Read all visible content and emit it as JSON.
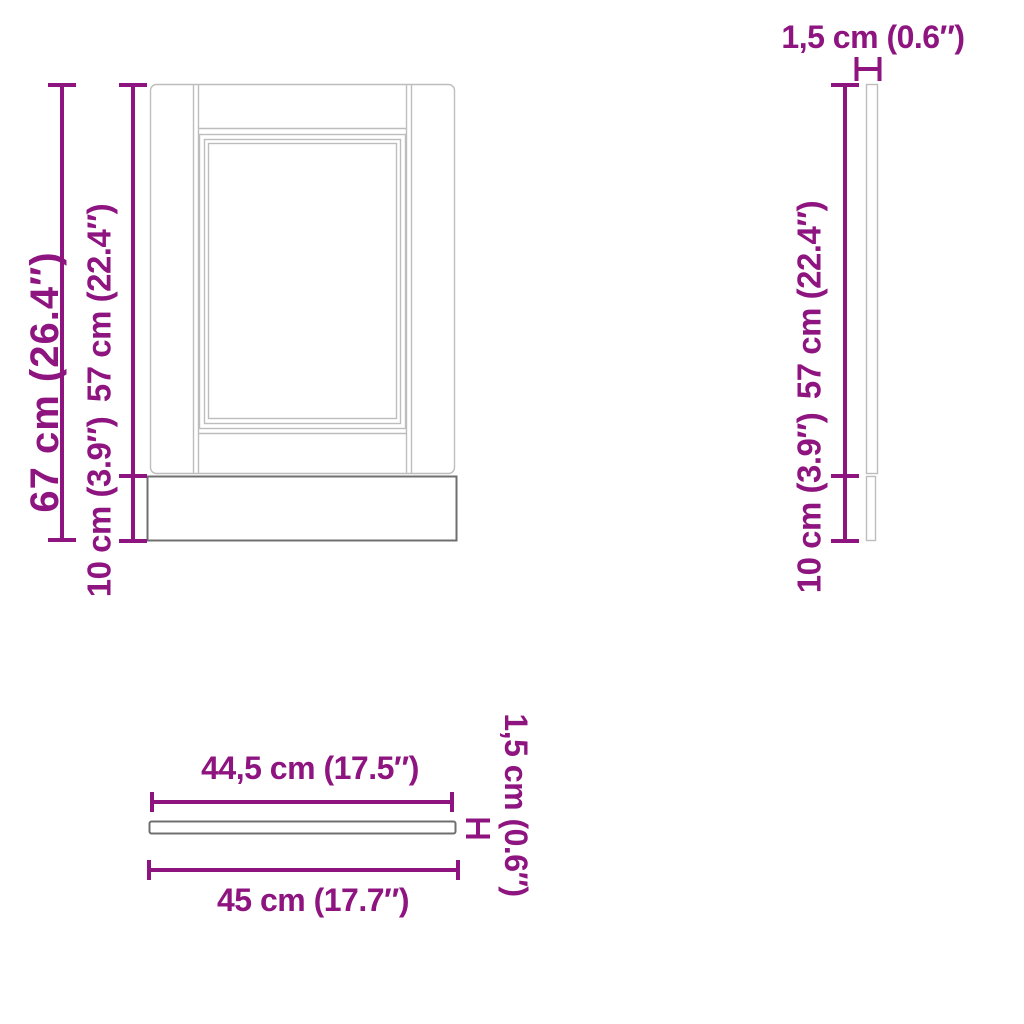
{
  "diagram_title": "cabinet-panel-dimension-diagram",
  "colors": {
    "dimension": "#8E1480",
    "outline_light": "#BDBDBD",
    "outline_dark": "#6F6F6F",
    "background": "#FFFFFF"
  },
  "views": {
    "front": {
      "labels": {
        "total_height": "67 cm (26.4″)",
        "door_height": "57 cm (22.4″)",
        "plinth_height": "10 cm (3.9″)"
      }
    },
    "side": {
      "labels": {
        "thickness": "1,5 cm (0.6″)",
        "door_height": "57 cm (22.4″)",
        "plinth_height": "10 cm (3.9″)"
      }
    },
    "top": {
      "labels": {
        "inner_width": "44,5 cm (17.5″)",
        "outer_width": "45 cm (17.7″)",
        "thickness": "1,5 cm (0.6″)"
      }
    }
  }
}
